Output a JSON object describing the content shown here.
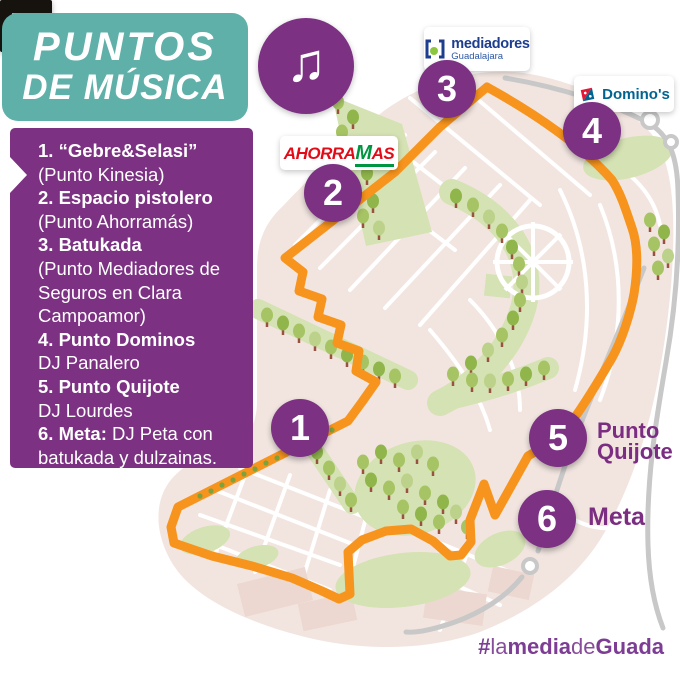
{
  "header": {
    "title_line1": "PUNTOS",
    "title_line2": "DE MÚSICA"
  },
  "icons": {
    "music_note": "♫"
  },
  "music_points": {
    "lines": [
      {
        "b": "1. “Gebre&Selasi”",
        "r": ""
      },
      {
        "b": "",
        "r": "(Punto Kinesia)"
      },
      {
        "b": "2. Espacio pistolero",
        "r": ""
      },
      {
        "b": "",
        "r": "(Punto Ahorramás)"
      },
      {
        "b": "3. Batukada",
        "r": ""
      },
      {
        "b": "",
        "r": "(Punto Mediadores de"
      },
      {
        "b": "",
        "r": "Seguros en Clara"
      },
      {
        "b": "",
        "r": "Campoamor)"
      },
      {
        "b": "4. Punto Dominos",
        "r": ""
      },
      {
        "b": "",
        "r": "DJ Panalero"
      },
      {
        "b": "5. Punto Quijote",
        "r": ""
      },
      {
        "b": "",
        "r": "DJ Lourdes"
      },
      {
        "b": "6. Meta:",
        "r": " DJ Peta con"
      },
      {
        "b": "",
        "r": "batukada y dulzainas."
      }
    ]
  },
  "markers": [
    {
      "number": "1"
    },
    {
      "number": "2"
    },
    {
      "number": "3"
    },
    {
      "number": "4"
    },
    {
      "number": "5"
    },
    {
      "number": "6"
    }
  ],
  "map_labels": {
    "point5_line1": "Punto",
    "point5_line2": "Quijote",
    "point6": "Meta"
  },
  "logos": {
    "ahorramas": {
      "part1": "Ahorra",
      "part2": "M",
      "part3": "as"
    },
    "mediadores": {
      "name": "mediadores",
      "region": "Guadalajara"
    },
    "dominos": {
      "name": "Domino's"
    },
    "kinesia": {
      "letter": "K"
    }
  },
  "hashtag": {
    "hash": "#",
    "p1": "la",
    "p2": "media",
    "p3": "de",
    "p4": "Guada"
  },
  "colors": {
    "purple": "#7c3183",
    "teal": "#5fb0a9",
    "route_orange": "#f7941d",
    "road_gray": "#c8c8c8",
    "map_pink": "#f2e5e0",
    "park_green": "#d5e2b3",
    "hashtag_purple": "#7d3d94"
  }
}
